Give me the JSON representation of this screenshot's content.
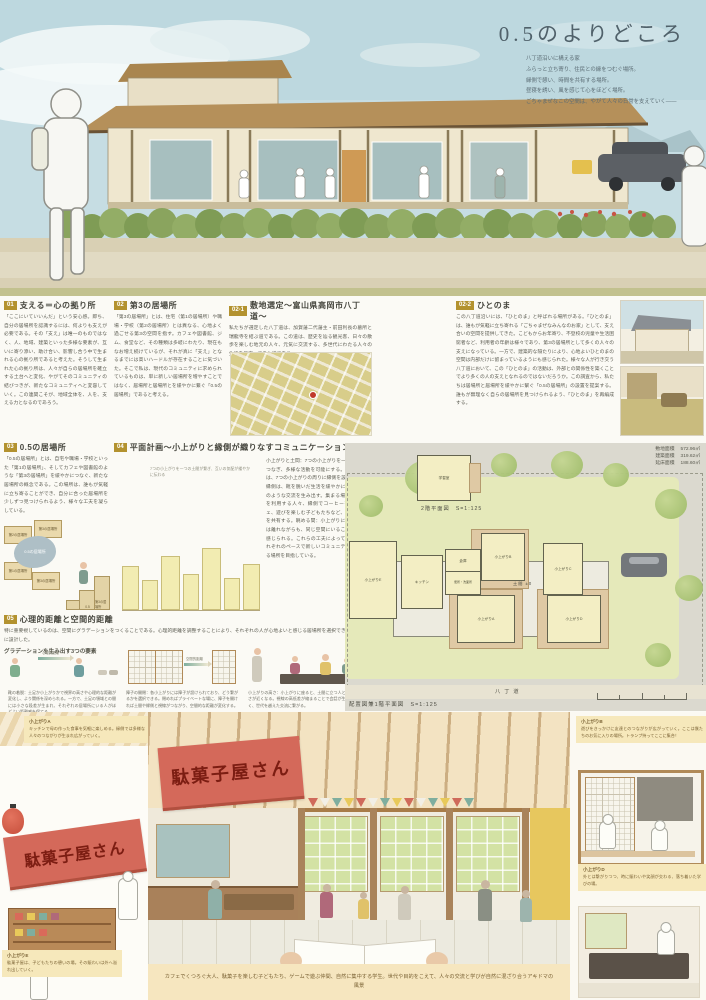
{
  "title": "0.5のよりどころ",
  "intro": {
    "l1": "八丁道沿いに構える家",
    "l2": "ふらっと立ち寄り、住民との縁をつむぐ場所。",
    "l3": "縁側で憩い、時間を共有する場所。",
    "l4": "昼寝を誘い、風を感じて心をほどく場所。",
    "l5": "ごちゃまぜなこの空間は、やがて人々の日常を支えていく——"
  },
  "sections": {
    "s01": {
      "num": "01",
      "title": "支える＝心の拠り所",
      "body": "「ここにいていいんだ」という安心感。即ち、自分の居場所を認識するには、何よりも支えが必要である。その「支え」は唯一のものではなく、人、地域、建築といった多様な要素が、互いに寄り添い、助け合い、影響し合う中で生まれる心の拠り所であると考えた。そうして生まれた心の拠り所は、人々が自らの居場所を確立する土台へと変化、やがてそのコミュニティの結びつきが、新たなコミュニティへと変容していく。この連関こそが、地域全体を、人を、支える力となるのであろう。"
    },
    "s02": {
      "num": "02",
      "title": "第3の居場所",
      "body": "「第3の居場所」とは、住宅（第1の居場所）や職場・学校（第2の居場所）とは異なる、心地よく過ごせる第3の空間を指す。カフェや図書館、ジム、食堂など、その種類は多岐にわたり、現在もなお増え続けているが、それが真に「支え」となるまでには高いハードルが存在することに気づいた。そこで私は、現代のコミュニティに求められているものは、単に新しい居場所を増やすことではなく、居場所と居場所とを緩やかに繋ぐ「0.5の居場所」であると考える。"
    },
    "s021": {
      "num": "02-1",
      "title": "敷地選定〜富山県高岡市八丁道〜",
      "body": "私たちが選定した八丁道は、加賀藩二代藩主・前田利長の墓所と瑞龍寺を結ぶ道である。この道は、歴史を辿る観光客、日々の散歩を楽しむ地元の人々、元気に交流する、多世代にわたる人々の生活を見守ってきた道である。"
    },
    "s022": {
      "num": "02-2",
      "title": "ひとのま",
      "body": "この八丁道沿いには、「ひとのま」と呼ばれる場所がある。「ひとのま」は、誰もが気軽に立ち寄れる「ごちゃまぜなみんなのお家」として、支え合いの空間を提供してきた。こどもからお年寄り、不登校の児童や生活困窮者など、利用者の年齢は様々であり、第3の居場所として多くの人々の支えになっている。一方で、建築的な隔たりにより、心地よいひとのまの空間は内部だけに留まっているようにも感じられた。様々な人が行き交う八丁道において、この「ひとのま」の活動は、外部との関係性を築くことでより多くの人の支えとなれるのではないだろうか。この調査から、私たちは居場所と居場所を緩やかに繋ぐ「0.5の居場所」の設置を提案する。誰もが無理なく自らの居場所を見つけられるよう、「ひとのま」を再編成する。"
    },
    "s03": {
      "num": "03",
      "title": "0.5の居場所",
      "body": "「0.5の居場所」とは、自宅や職場・学校といった「第1の居場所」、そしてカフェや図書館のような「第3の居場所」を緩やかにつなぐ、新たな居場所の概念である。この場所は、誰もが気軽に立ち寄ることができ、自分に合った居場所を少しずつ見つけられるよう、様々な工夫を凝らしている。"
    },
    "s04": {
      "num": "04",
      "title": "平面計画〜小上がりと縁側が織りなすコミュニケーション〜",
      "body": "小上がりと土間：7つの小上がりを一つの土間でつなぎ、多様な活動を可能にする。この場所では、7つの小上がりの周りに縁側を設けている。縁側は、靴を脱いだ生活を緩やかに繋ぎ、以下のような交流を生み出す。集まる場：小上がりを利用する人々、縁側でコーヒーを飲むカフェ、遊びを楽しむ子どもたちなど、様々な活動を共有する。眺める間：小上がりにいる人々とは離れながらも、同じ空間にいることで気配を感じられる。これらの工夫によって、人々がそれぞれのペースで新しいコミュニティと出会える場所を目指している。",
      "note": "7つの小上がりを一つの土間が繋ぎ、互いの気配が緩やかに伝わる"
    },
    "s05": {
      "num": "05",
      "title": "心理的距離と空間的距離",
      "body": "特に重要視しているのは、空間にグラデーションをつくることである。心理的距離を調整することにより、それぞれの人が心地よいと感じる居場所を選択できるように設計した。",
      "subtitle": "グラデーションを生み出す3つの要素",
      "arrow1": "心理的距離",
      "arrow2": "空間的距離",
      "cap1": "靴の着脱：土足か小上がりかで視界の高さや心理的な距離が変化し、より関係を深められる。一方で、土足の領域との間には小さな段差が生まれ、それぞれの居場所にいる人がほどよい距離感を保てる。",
      "cap2": "障子の開閉：各小上がりには障子が設けられており、どう繋がるかを選択できる。閉めればプライベートな場に、障子を開ければ土間や縁側と視線がつながり、空間的な距離が変化する。",
      "cap3": "小上がりの高さ：小上がりに座ると、土間に立つ人と目線の高さが近くなる。視線の高低差が縮まることで会話が生まれやすく、世代を越えた交流に繋がる。"
    }
  },
  "diagram03": {
    "blob": "0.5の居場所",
    "box1": "第2の居場所",
    "box2": "第3の居場所",
    "box3": "第1の居場所",
    "box4": "第3の居場所",
    "step": "0.5",
    "step_tall": "第3の居場所"
  },
  "plan": {
    "stats": [
      {
        "label": "敷地面積",
        "value": "572.96㎡"
      },
      {
        "label": "建築面積",
        "value": "319.62㎡"
      },
      {
        "label": "延床面積",
        "value": "188.60㎡"
      }
    ],
    "plan2f": "2階平面図　S=1:125",
    "plan1f": "配置図兼1階平面図　S=1:125",
    "street": "八丁道",
    "rooms": {
      "a": "小上がりA",
      "b": "小上がりB",
      "c": "小上がりC",
      "d": "小上がりD",
      "e": "小上がりE",
      "kitchen": "キッチン",
      "storage": "倉庫",
      "wc": "便所・洗面所",
      "doma": "土間 ±0",
      "study": "学習室"
    }
  },
  "captions": {
    "a": {
      "title": "小上がりA",
      "body": "キッチンで母の作った食事を気軽に楽しめる。縁側では多様な人々のつながりが生まれ広がっていく。"
    },
    "b": {
      "title": "小上がりB",
      "body": "遊びをきっかけに友達とのつながりが広がっていく。ここは僕たちのお気に入りの場所。トランプ持ってここに集合！"
    },
    "d": {
      "title": "小上がりD",
      "body": "外とは繋がりつつ、時に賑わいや笑顔が交わる、落ち着いた学びの場。"
    },
    "e": {
      "title": "小上がりE",
      "body": "駄菓子屋は、子どもたちの憩いの場。その賑わいは外へ溢れ出していく。"
    },
    "bottom": "カフェでくつろぐ大人、駄菓子を楽しむ子どもたち、ゲームで遊ぶ仲間、自然に集中する学生。世代や目的をこえて、人々の交流と学びが自然に混ざり合うアキドマの風景"
  },
  "banner": "駄菓子屋さん"
}
